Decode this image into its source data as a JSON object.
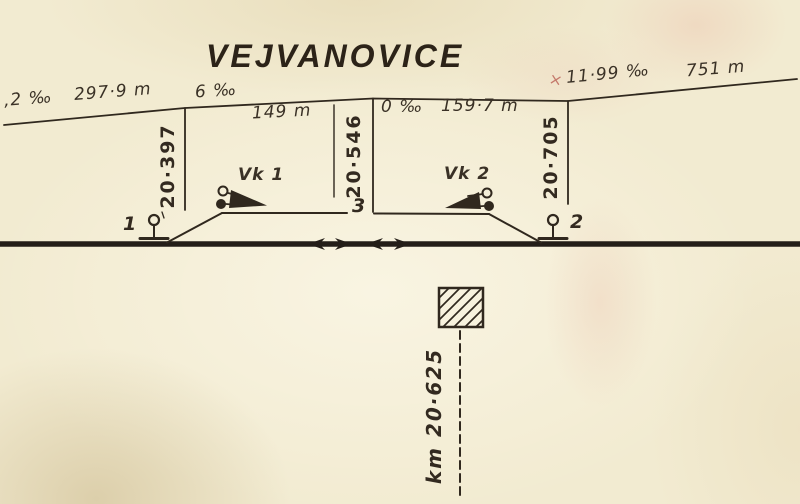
{
  "title": "VEJVANOVICE",
  "gradient_profile": {
    "segments": [
      {
        "grade": ",2 ‰",
        "length": "297·9 m"
      },
      {
        "grade": "6 ‰",
        "length": "149 m"
      },
      {
        "grade": "0 ‰",
        "length": "159·7 m"
      },
      {
        "grade": "11·99 ‰",
        "length": "751 m"
      }
    ],
    "check_mark": "×",
    "km_posts": [
      "20·397",
      "20·546",
      "20·705"
    ]
  },
  "tracks": {
    "signal_left_label": "1",
    "signal_right_label": "2",
    "siding_track_label": "3",
    "derail_left_label": "Vk 1",
    "derail_right_label": "Vk 2"
  },
  "station_axis": {
    "km_label": "km 20·625"
  },
  "colors": {
    "paper": "#f2ebd1",
    "ink": "#30281e",
    "stain_pink": "#e0a890",
    "check_red": "#c4796b"
  }
}
